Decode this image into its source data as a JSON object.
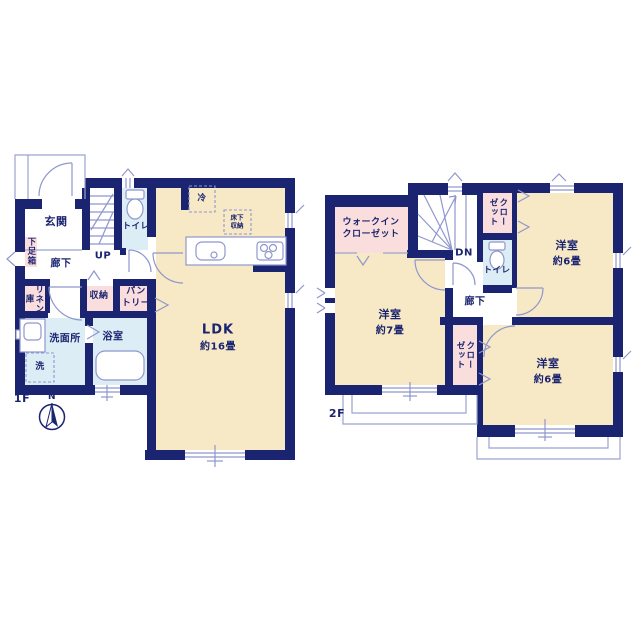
{
  "plan": {
    "floor1": {
      "label": "1F",
      "compass": "N",
      "rooms": {
        "genkan": "玄関",
        "shoe_box": "下足箱",
        "hallway": "廊下",
        "stairs": "UP",
        "toilet": "トイレ",
        "linen": "リネン庫",
        "storage": "収納",
        "pantry": "パン\nトリー",
        "washroom": "洗面所",
        "washer": "洗",
        "bathroom": "浴室",
        "refrigerator": "冷",
        "underfloor_storage": "床下\n収納",
        "ldk": "LDK",
        "ldk_size": "約16畳"
      }
    },
    "floor2": {
      "label": "2F",
      "rooms": {
        "walk_in_closet": "ウォークイン\nクローゼット",
        "stairs": "DN",
        "closet_top": "クローゼット",
        "toilet": "トイレ",
        "hallway": "廊下",
        "bedroom_ne": "洋室",
        "bedroom_ne_size": "約6畳",
        "bedroom_w": "洋室",
        "bedroom_w_size": "約7畳",
        "closet_mid": "クローゼット",
        "bedroom_se": "洋室",
        "bedroom_se_size": "約6畳"
      }
    },
    "colors": {
      "wall": "#1b2470",
      "text": "#1b2470",
      "room_cream": "#f7e9c5",
      "room_pink": "#fadede",
      "room_blue": "#dcedf6",
      "fixture_line": "#8f97cd",
      "outline_line": "#9aa3d0"
    }
  }
}
